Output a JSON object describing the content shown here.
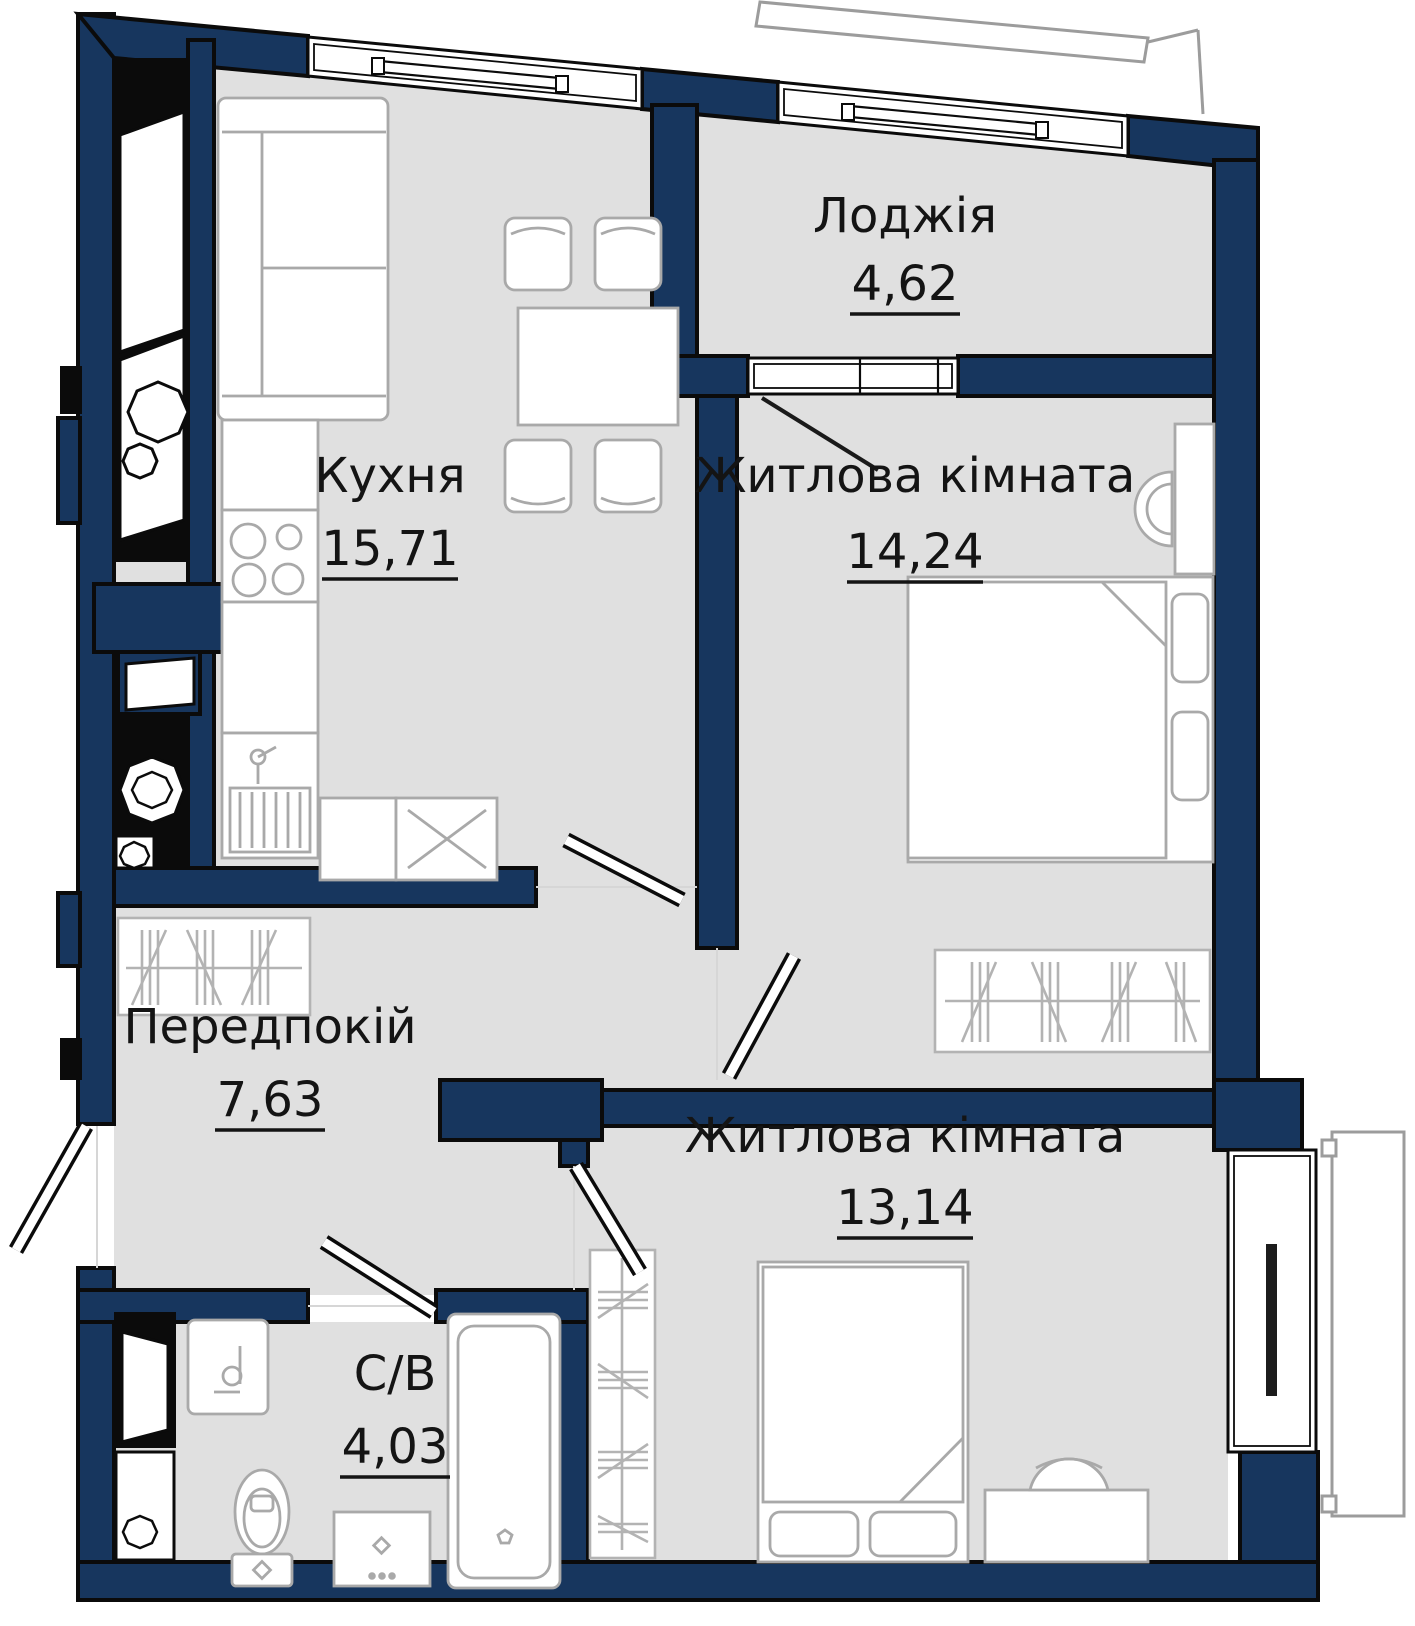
{
  "plan": {
    "type": "apartment-floor-plan",
    "rooms": [
      {
        "id": "loggia",
        "label": "Лоджія",
        "area": "4,62"
      },
      {
        "id": "kitchen",
        "label": "Кухня",
        "area": "15,71"
      },
      {
        "id": "bedroom1",
        "label": "Житлова кімната",
        "area": "14,24"
      },
      {
        "id": "hallway",
        "label": "Передпокій",
        "area": "7,63"
      },
      {
        "id": "bedroom2",
        "label": "Житлова кімната",
        "area": "13,14"
      },
      {
        "id": "bathroom",
        "label": "С/В",
        "area": "4,03"
      }
    ],
    "colors": {
      "wall": "#17365e",
      "wall_outline": "#0b0b0b",
      "floor": "#e0e0e0",
      "furniture_stroke": "#a9a9a9",
      "hatch_stroke": "#b3b3b3",
      "exterior_window_gray": "#9c9c9c",
      "label_text": "#141414"
    },
    "icons": [
      "sofa",
      "dining-table",
      "stool",
      "stove",
      "kitchen-sink",
      "fridge",
      "wardrobe",
      "double-bed",
      "pillow",
      "nightstand",
      "armchair",
      "desk",
      "chair",
      "toilet",
      "washbasin",
      "washing-machine",
      "bathtub",
      "window",
      "balcony-door",
      "door-leaf",
      "vent-shaft"
    ]
  }
}
